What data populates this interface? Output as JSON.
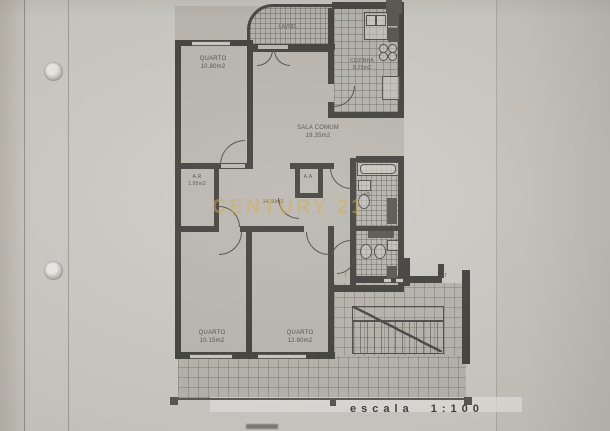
{
  "photo": {
    "watermark": "CENTURY 21"
  },
  "plan": {
    "scale_label": "escala 1:100",
    "up_arrow": "↑",
    "rooms": {
      "quarto_top": {
        "name": "QUARTO",
        "area": "10.80m2"
      },
      "balcony": {
        "name": "LAVND."
      },
      "kitchen": {
        "name": "COZINHA",
        "area": "8.25m2"
      },
      "living": {
        "name": "SALA COMUM",
        "area": "19.35m2"
      },
      "ar": {
        "name": "A.R",
        "area": "1.95m2"
      },
      "aa": {
        "name": "A.A"
      },
      "hall": {
        "area": "14.30m2"
      },
      "wc": {
        "name": "I.S."
      },
      "quarto_bl": {
        "name": "QUARTO",
        "area": "10.15m2"
      },
      "quarto_bm": {
        "name": "QUARTO",
        "area": "12.80m2"
      }
    }
  }
}
